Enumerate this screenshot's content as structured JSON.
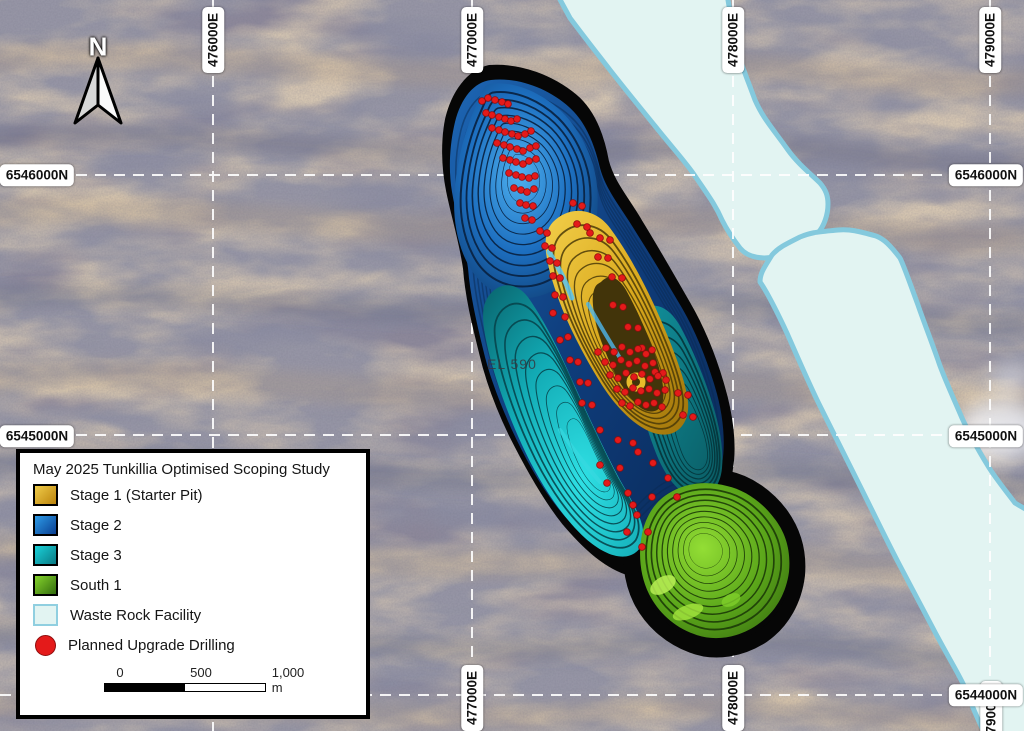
{
  "map": {
    "north_label": "N",
    "tenement_label": "EL 590",
    "graticule": {
      "top": [
        "476000E",
        "477000E",
        "478000E",
        "479000E"
      ],
      "bottom": [
        "477000E",
        "478000E",
        "479000E"
      ],
      "left": [
        "6546000N",
        "6545000N"
      ],
      "right": [
        "6546000N",
        "6545000N",
        "6544000N"
      ]
    },
    "drill_points": [
      [
        482,
        101
      ],
      [
        488,
        98
      ],
      [
        495,
        100
      ],
      [
        502,
        102
      ],
      [
        508,
        104
      ],
      [
        486,
        113
      ],
      [
        492,
        115
      ],
      [
        499,
        117
      ],
      [
        505,
        119
      ],
      [
        511,
        121
      ],
      [
        517,
        119
      ],
      [
        492,
        128
      ],
      [
        499,
        130
      ],
      [
        505,
        132
      ],
      [
        512,
        134
      ],
      [
        518,
        136
      ],
      [
        525,
        134
      ],
      [
        531,
        131
      ],
      [
        497,
        143
      ],
      [
        504,
        145
      ],
      [
        510,
        147
      ],
      [
        517,
        149
      ],
      [
        523,
        151
      ],
      [
        530,
        148
      ],
      [
        536,
        146
      ],
      [
        503,
        158
      ],
      [
        510,
        160
      ],
      [
        516,
        162
      ],
      [
        523,
        164
      ],
      [
        529,
        161
      ],
      [
        536,
        159
      ],
      [
        509,
        173
      ],
      [
        516,
        175
      ],
      [
        522,
        177
      ],
      [
        529,
        178
      ],
      [
        535,
        176
      ],
      [
        514,
        188
      ],
      [
        521,
        190
      ],
      [
        527,
        192
      ],
      [
        534,
        189
      ],
      [
        520,
        203
      ],
      [
        526,
        205
      ],
      [
        533,
        206
      ],
      [
        525,
        218
      ],
      [
        532,
        220
      ],
      [
        540,
        231
      ],
      [
        547,
        233
      ],
      [
        573,
        203
      ],
      [
        582,
        206
      ],
      [
        577,
        224
      ],
      [
        587,
        227
      ],
      [
        545,
        246
      ],
      [
        552,
        248
      ],
      [
        550,
        261
      ],
      [
        557,
        263
      ],
      [
        590,
        233
      ],
      [
        600,
        238
      ],
      [
        610,
        240
      ],
      [
        553,
        276
      ],
      [
        560,
        278
      ],
      [
        598,
        257
      ],
      [
        608,
        258
      ],
      [
        555,
        295
      ],
      [
        563,
        297
      ],
      [
        612,
        277
      ],
      [
        622,
        278
      ],
      [
        553,
        313
      ],
      [
        565,
        317
      ],
      [
        613,
        305
      ],
      [
        623,
        307
      ],
      [
        560,
        340
      ],
      [
        568,
        337
      ],
      [
        628,
        327
      ],
      [
        638,
        328
      ],
      [
        570,
        360
      ],
      [
        578,
        362
      ],
      [
        642,
        348
      ],
      [
        652,
        350
      ],
      [
        580,
        382
      ],
      [
        588,
        383
      ],
      [
        655,
        372
      ],
      [
        663,
        373
      ],
      [
        582,
        403
      ],
      [
        592,
        405
      ],
      [
        598,
        352
      ],
      [
        606,
        348
      ],
      [
        614,
        352
      ],
      [
        622,
        347
      ],
      [
        630,
        352
      ],
      [
        638,
        349
      ],
      [
        646,
        354
      ],
      [
        605,
        362
      ],
      [
        613,
        365
      ],
      [
        621,
        360
      ],
      [
        629,
        364
      ],
      [
        637,
        361
      ],
      [
        645,
        366
      ],
      [
        653,
        363
      ],
      [
        610,
        375
      ],
      [
        618,
        378
      ],
      [
        626,
        373
      ],
      [
        634,
        377
      ],
      [
        642,
        374
      ],
      [
        650,
        379
      ],
      [
        658,
        376
      ],
      [
        666,
        380
      ],
      [
        617,
        389
      ],
      [
        625,
        392
      ],
      [
        633,
        388
      ],
      [
        641,
        391
      ],
      [
        649,
        389
      ],
      [
        657,
        393
      ],
      [
        665,
        390
      ],
      [
        622,
        403
      ],
      [
        630,
        406
      ],
      [
        638,
        402
      ],
      [
        646,
        405
      ],
      [
        654,
        403
      ],
      [
        662,
        407
      ],
      [
        678,
        393
      ],
      [
        688,
        395
      ],
      [
        683,
        415
      ],
      [
        693,
        417
      ],
      [
        600,
        430
      ],
      [
        618,
        440
      ],
      [
        633,
        443
      ],
      [
        653,
        463
      ],
      [
        638,
        452
      ],
      [
        600,
        465
      ],
      [
        620,
        468
      ],
      [
        607,
        483
      ],
      [
        628,
        493
      ],
      [
        652,
        497
      ],
      [
        668,
        478
      ],
      [
        677,
        497
      ],
      [
        637,
        515
      ],
      [
        627,
        532
      ],
      [
        648,
        532
      ],
      [
        642,
        547
      ],
      [
        633,
        505
      ]
    ]
  },
  "legend": {
    "title": "May 2025 Tunkillia Optimised Scoping Study",
    "items": [
      {
        "label": "Stage 1 (Starter Pit)",
        "shape": "square",
        "color_start": "#f0cc4a",
        "color_end": "#bb830c",
        "border": "#000000"
      },
      {
        "label": "Stage 2",
        "shape": "square",
        "color_start": "#2e9ce8",
        "color_end": "#0a3f92",
        "border": "#000000"
      },
      {
        "label": "Stage 3",
        "shape": "square",
        "color_start": "#1ad2da",
        "color_end": "#0a7a84",
        "border": "#000000"
      },
      {
        "label": "South 1",
        "shape": "square",
        "color_start": "#86d42c",
        "color_end": "#336c0e",
        "border": "#000000"
      },
      {
        "label": "Waste Rock Facility",
        "shape": "square",
        "color_start": "#e2f4f2",
        "color_end": "#e2f4f2",
        "border": "#90cfe0"
      },
      {
        "label": "Planned Upgrade Drilling",
        "shape": "circle",
        "color_start": "#e41a1a",
        "color_end": "#e41a1a",
        "border": "#8f0d0d"
      }
    ],
    "scalebar": {
      "ticks": [
        "0",
        "500",
        "1,000 m"
      ]
    }
  },
  "colors": {
    "drill_dot": "#e41a1a",
    "drill_dot_edge": "#8f0d0d",
    "waste_fill": "#e2f4f2",
    "waste_border": "#84c9dd",
    "grid_line": "#ffffff"
  }
}
